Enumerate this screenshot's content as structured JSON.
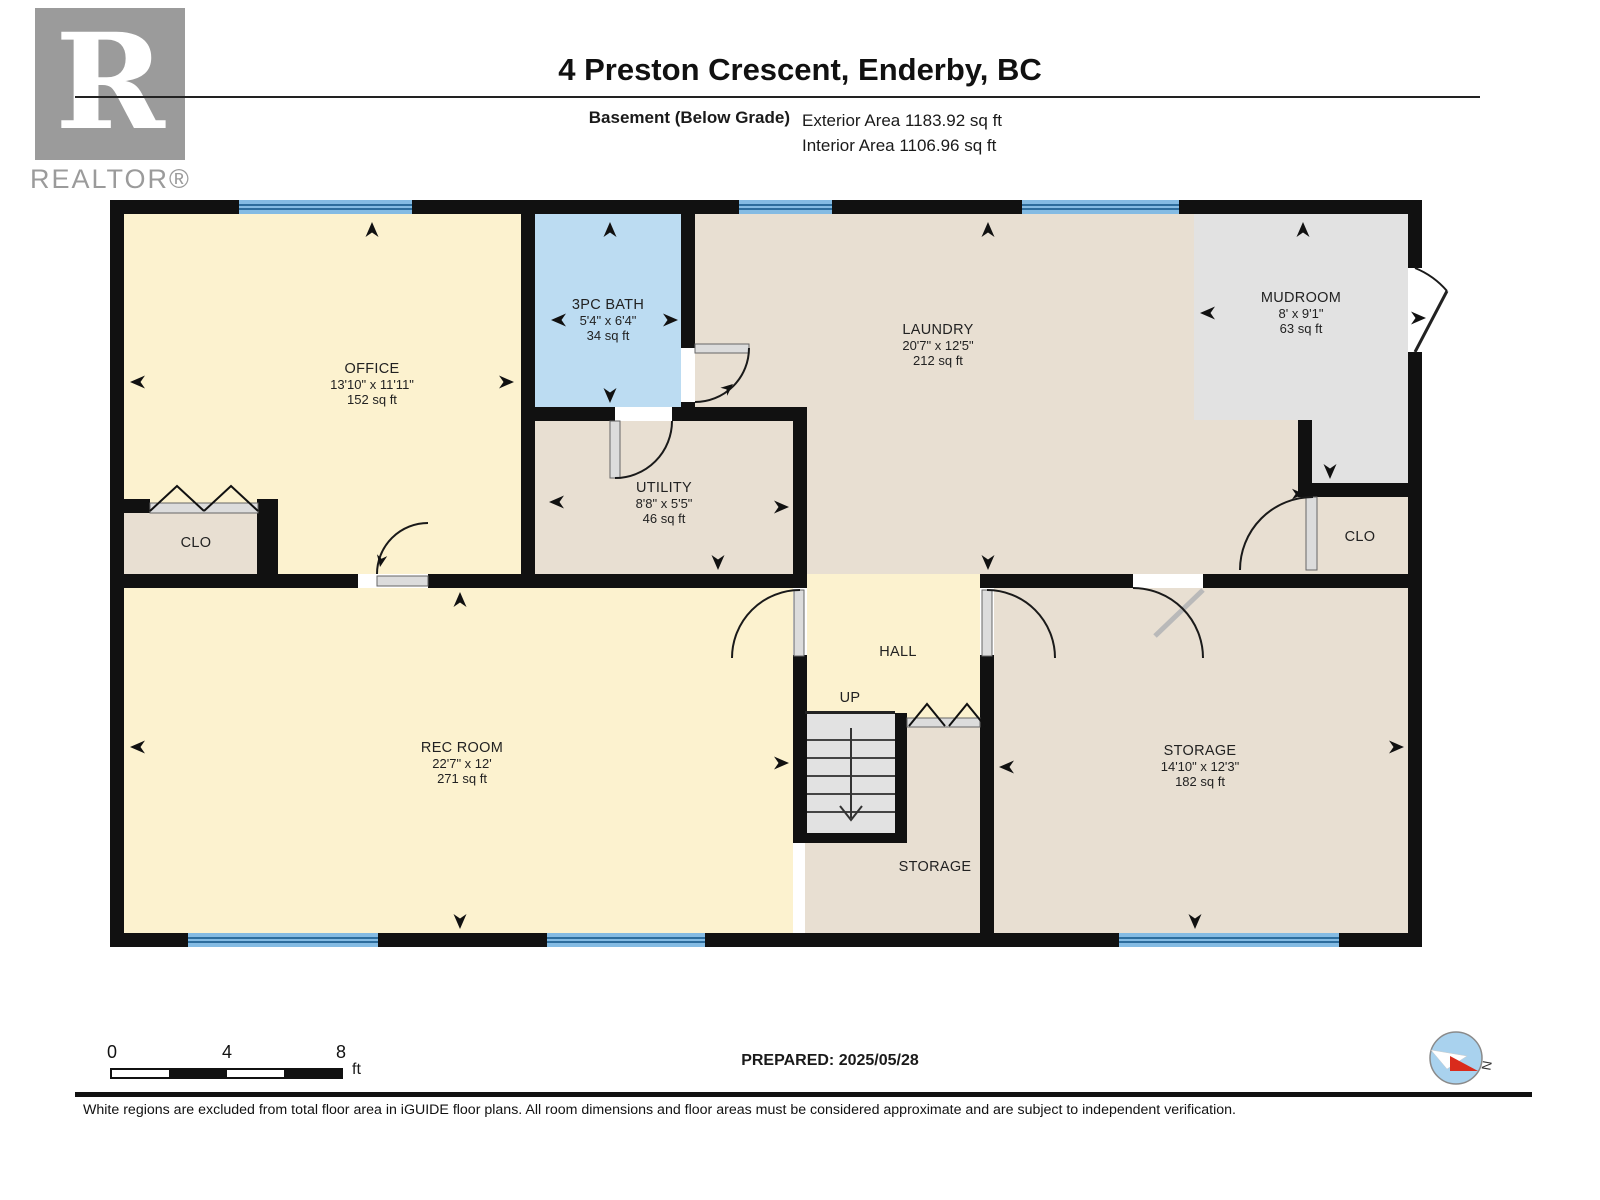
{
  "header": {
    "logo": {
      "letter": "R",
      "brand": "REALTOR®"
    },
    "title": "4 Preston Crescent, Enderby, BC",
    "floor_label": "Basement (Below Grade)",
    "exterior_area": "Exterior Area 1183.92 sq ft",
    "interior_area": "Interior Area 1106.96 sq ft"
  },
  "rooms": {
    "office": {
      "name": "OFFICE",
      "dims": "13'10\" x 11'11\"",
      "area": "152 sq ft"
    },
    "bath": {
      "name": "3PC BATH",
      "dims": "5'4\" x 6'4\"",
      "area": "34 sq ft"
    },
    "laundry": {
      "name": "LAUNDRY",
      "dims": "20'7\" x 12'5\"",
      "area": "212 sq ft"
    },
    "mudroom": {
      "name": "MUDROOM",
      "dims": "8' x 9'1\"",
      "area": "63 sq ft"
    },
    "utility": {
      "name": "UTILITY",
      "dims": "8'8\" x 5'5\"",
      "area": "46 sq ft"
    },
    "clo_left": {
      "name": "CLO"
    },
    "clo_right": {
      "name": "CLO"
    },
    "rec_room": {
      "name": "REC ROOM",
      "dims": "22'7\" x 12'",
      "area": "271 sq ft"
    },
    "hall": {
      "name": "HALL"
    },
    "stairs": {
      "name": "UP"
    },
    "storage": {
      "name": "STORAGE",
      "dims": "14'10\" x 12'3\"",
      "area": "182 sq ft"
    },
    "storage_small": {
      "name": "STORAGE"
    }
  },
  "scale_bar": {
    "t0": "0",
    "t1": "4",
    "t2": "8",
    "unit": "ft"
  },
  "compass": {
    "north_label": "N"
  },
  "footer": {
    "prepared": "PREPARED: 2025/05/28",
    "disclaimer": "White regions are excluded from total floor area in iGUIDE floor plans. All room dimensions and floor areas must be considered approximate and are subject to independent verification."
  },
  "colors": {
    "wall": "#111111",
    "room_cream": "#fcf2cf",
    "room_beige": "#e8dfd2",
    "room_blue": "#bcdcf2",
    "room_gray": "#e2e2e2",
    "window_blue": "#84bbe3",
    "logo_gray": "#9b9b9b"
  }
}
